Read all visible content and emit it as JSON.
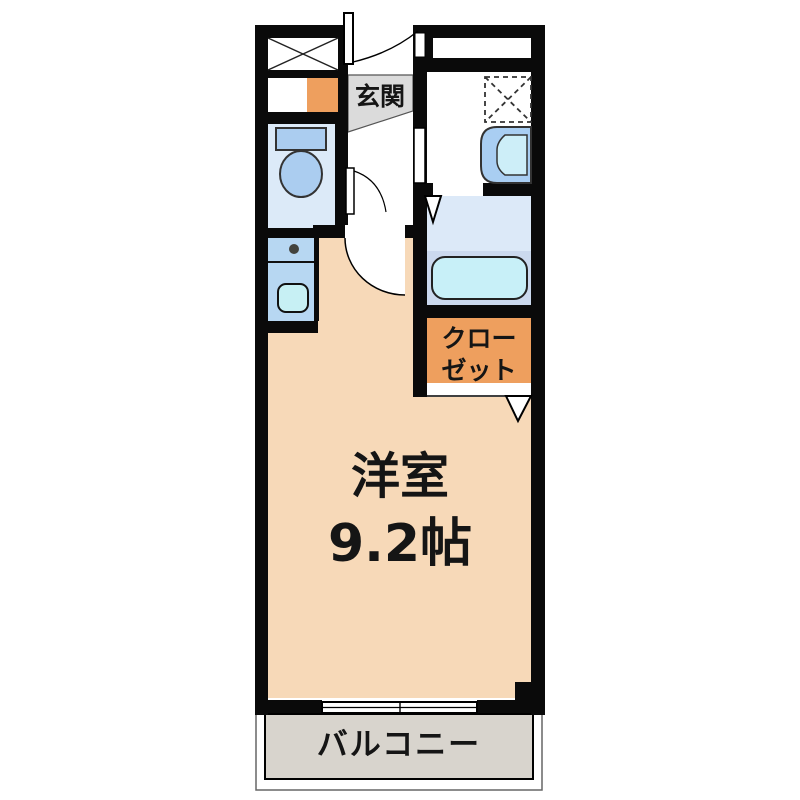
{
  "meta": {
    "kind": "japanese-apartment-floor-plan",
    "layout_type": "1R / studio"
  },
  "labels": {
    "entrance": "玄関",
    "room_name": "洋室",
    "room_size": "9.2帖",
    "closet_line1": "クロー",
    "closet_line2": "ゼット",
    "balcony": "バルコニー"
  },
  "fixtures": {
    "toilet": "toilet-icon",
    "kitchen_sink": "kitchen-sink-icon",
    "stove_burner": "stove-burner-icon",
    "bathtub": "bathtub-icon",
    "washbasin": "washbasin-icon",
    "washing_machine_space": "washing-machine-space-icon",
    "pipe_space": "pipe-space-icon",
    "sliding_window": "sliding-window-icon"
  },
  "colors": {
    "wall": "#0a0a0a",
    "main_room": "#f7d9b8",
    "closet": "#ee9f5e",
    "entrance_floor": "#dbdbdb",
    "balcony": "#d8d4cd",
    "toilet_room": "#dceaf8",
    "kitchen": "#b7d7f2",
    "bath_floor": "#dce9f8",
    "bath_tub_zone": "#cbd9ee",
    "tub": "#c8f0f8",
    "fixture_blue": "#abcdf0",
    "sink": "#c7f0f4",
    "basin_inner": "#cdeef8",
    "text": "#151515"
  }
}
